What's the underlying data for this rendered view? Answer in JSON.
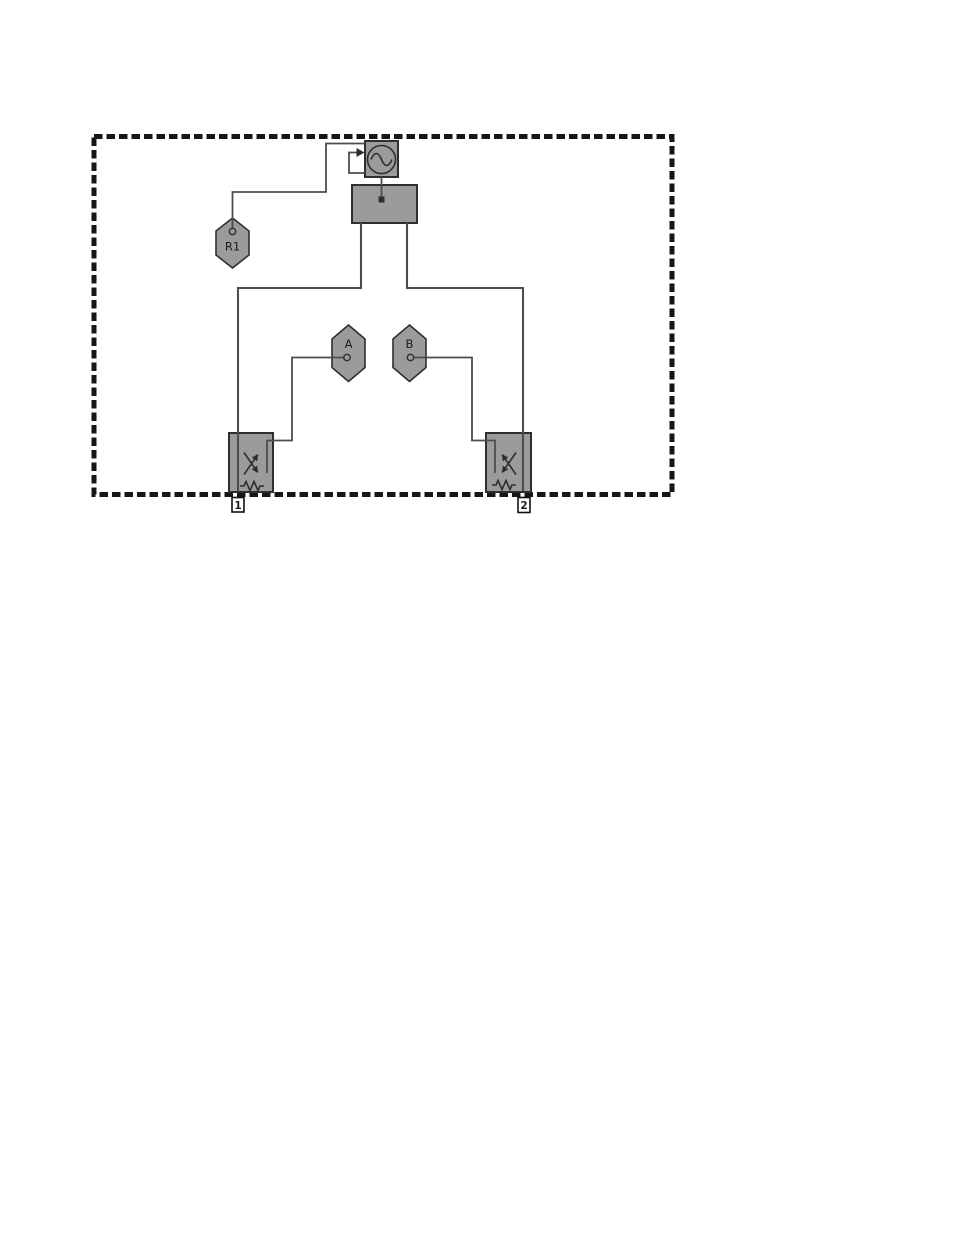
{
  "colors": {
    "background": "#ffffff",
    "shape_fill": "#9a9c9c",
    "shape_border": "#2e2e2e",
    "wire": "#4d4d4d",
    "dashed_border": "#161616",
    "label_text": "#1c1c1c",
    "port_label_bg": "#ffffff",
    "port_label_border": "#111111"
  },
  "labels": {
    "receivers": {
      "r1": "R1",
      "a": "A",
      "b": "B"
    },
    "ports": {
      "p1": "1",
      "p2": "2"
    }
  },
  "icons": {
    "source": "sine-source-icon",
    "feedback": "feedback-arrow-icon",
    "coupler": "crossed-arrows-coupler-icon",
    "load": "resistor-icon"
  }
}
